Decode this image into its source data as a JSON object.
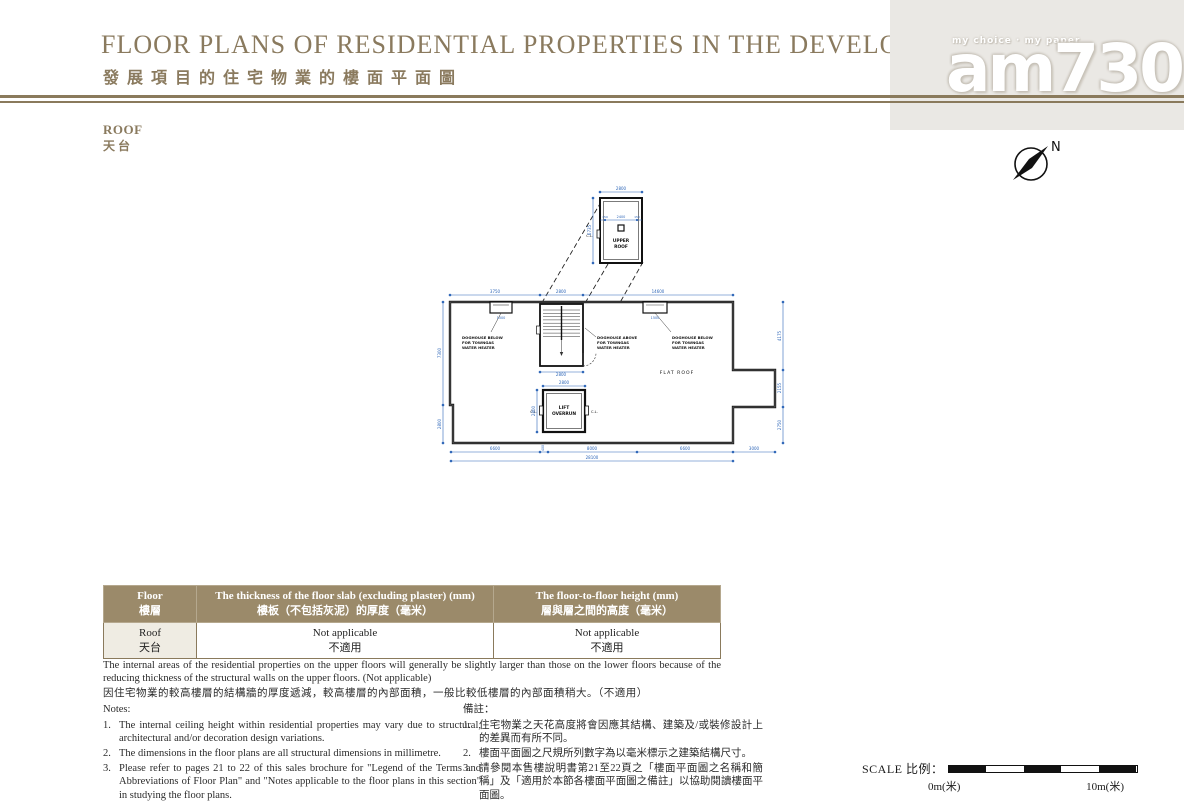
{
  "colors": {
    "accent": "#8a7a5c",
    "dimension_blue": "#2e66b8",
    "table_header_bg": "#9b8a6a",
    "logo_panel_bg": "#eae8e4"
  },
  "header": {
    "title_en": "FLOOR PLANS OF RESIDENTIAL PROPERTIES IN THE DEVELOPMENT",
    "title_zh": "發展項目的住宅物業的樓面平面圖",
    "logo_tagline": "my choice · my paper",
    "logo_name": "am730"
  },
  "section": {
    "floor_en": "ROOF",
    "floor_zh": "天台"
  },
  "compass": {
    "north": "N"
  },
  "plan": {
    "labels": {
      "upper_roof": [
        "UPPER",
        "ROOF"
      ],
      "flat_roof": "FLAT ROOF",
      "lift_overrun": [
        "LIFT",
        "OVERRUN"
      ],
      "doghouse_below": [
        "DOGHOUSE BELOW",
        "FOR TOWNGAS",
        "WATER HEATER"
      ],
      "doghouse_above": [
        "DOGHOUSE ABOVE",
        "FOR TOWNGAS",
        "WATER HEATER"
      ],
      "cat_ladder": "C.L."
    },
    "dims": {
      "upper_top": "2800",
      "upper_mid": [
        "150",
        "2400",
        "150"
      ],
      "upper_left": "6735",
      "top": [
        "3750",
        "2800",
        "14600"
      ],
      "left": [
        "7300",
        "2800"
      ],
      "right": [
        "4175",
        "2155",
        "2750"
      ],
      "bottom": [
        "6600",
        "400",
        "8000",
        "6600",
        "3000"
      ],
      "bottom_total": "28100",
      "stair_bottom": "2800",
      "lift_top": "2800",
      "lift_left": "2800",
      "doghouse_width": "1500"
    }
  },
  "table": {
    "header": [
      {
        "en": "Floor",
        "zh": "樓層"
      },
      {
        "en": "The thickness of the floor slab (excluding plaster) (mm)",
        "zh": "樓板（不包括灰泥）的厚度（毫米）"
      },
      {
        "en": "The floor-to-floor height (mm)",
        "zh": "層與層之間的高度（毫米）"
      }
    ],
    "row": {
      "floor_en": "Roof",
      "floor_zh": "天台",
      "thickness_en": "Not applicable",
      "thickness_zh": "不適用",
      "height_en": "Not applicable",
      "height_zh": "不適用"
    }
  },
  "paragraph": {
    "en": "The internal areas of the residential properties on the upper floors will generally be slightly larger than those on the lower floors because of the reducing thickness of the structural walls on the upper floors. (Not applicable)",
    "zh": "因住宅物業的較高樓層的結構牆的厚度遞減，較高樓層的內部面積，一般比較低樓層的內部面積稍大。（不適用）"
  },
  "notes_en": {
    "heading": "Notes:",
    "nums": [
      "1.",
      "2.",
      "3."
    ],
    "items": [
      "The internal ceiling height within residential properties may vary due to structural, architectural and/or decoration design variations.",
      "The dimensions in the floor plans are all structural dimensions in millimetre.",
      "Please refer to pages 21 to 22 of this sales brochure for \"Legend of the Terms and Abbreviations of Floor Plan\" and \"Notes applicable to the floor plans in this section\" in studying the floor plans."
    ]
  },
  "notes_zh": {
    "heading": "備註：",
    "nums": [
      "1.",
      "2.",
      "3."
    ],
    "items": [
      "住宅物業之天花高度將會因應其結構、建築及/或裝修設計上的差異而有所不同。",
      "樓面平面圖之尺規所列數字為以毫米標示之建築結構尺寸。",
      "請參閱本售樓說明書第21至22頁之「樓面平面圖之名稱和簡稱」及「適用於本節各樓面平面圖之備註」以協助閱讀樓面平面圖。"
    ]
  },
  "scale": {
    "label": "SCALE 比例：",
    "start": "0m(米)",
    "end": "10m(米)"
  }
}
